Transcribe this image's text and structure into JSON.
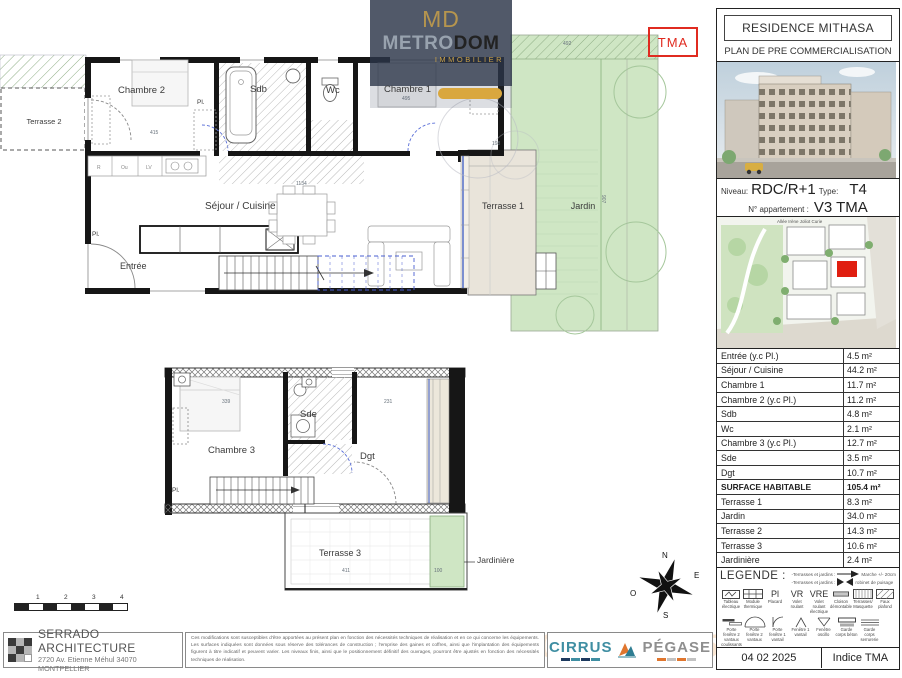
{
  "panel": {
    "title": "RESIDENCE MITHASA",
    "subtitle": "PLAN DE PRE COMMERCIALISATION",
    "niveau_label": "Niveau:",
    "niveau_value": "RDC/R+1",
    "type_label": "Type:",
    "type_value": "T4",
    "apartment_label": "N° appartement :",
    "apartment_value": "V3 TMA",
    "map_street": "Allée Irène Joliot Curie",
    "date": "04 02 2025",
    "indice": "Indice TMA"
  },
  "areas_table": {
    "rows": [
      {
        "label": "Entrée (y.c Pl.)",
        "value": "4.5 m²"
      },
      {
        "label": "Séjour / Cuisine",
        "value": "44.2 m²"
      },
      {
        "label": "Chambre 1",
        "value": "11.7 m²"
      },
      {
        "label": "Chambre 2 (y.c Pl.)",
        "value": "11.2 m²"
      },
      {
        "label": "Sdb",
        "value": "4.8 m²"
      },
      {
        "label": "Wc",
        "value": "2.1 m²"
      },
      {
        "label": "Chambre 3 (y.c Pl.)",
        "value": "12.7 m²"
      },
      {
        "label": "Sde",
        "value": "3.5 m²"
      },
      {
        "label": "Dgt",
        "value": "10.7 m²"
      },
      {
        "label": "SURFACE HABITABLE",
        "value": "105.4 m²"
      },
      {
        "label": "Terrasse 1",
        "value": "8.3 m²"
      },
      {
        "label": "Jardin",
        "value": "34.0 m²"
      },
      {
        "label": "Terrasse 2",
        "value": "14.3 m²"
      },
      {
        "label": "Terrasse 3",
        "value": "10.6 m²"
      },
      {
        "label": "Jardinière",
        "value": "2.4 m²"
      }
    ]
  },
  "legend": {
    "title": "LEGENDE :",
    "note1_label": "-Terrasses et jardins :",
    "note1_desc": "Marche +/- 20cm",
    "note2_label": "-Terrasses et jardins :",
    "note2_desc": "robinet de puisage",
    "codes": {
      "pl": "Pl",
      "vr": "VR",
      "vre": "VRE"
    },
    "row1": [
      "Tableau électrique",
      "Module thermique",
      "Placard",
      "Volet roulant",
      "Volet roulant électrique",
      "Cloison démontable",
      "Terrasses/ Masquette",
      "Faux plafond"
    ],
    "row2": [
      "Porte fenêtre 2 vantaux coulissants",
      "Porte fenêtre 2 vantaux",
      "Porte fenêtre 1 vantail",
      "Fenêtre 1 vantail",
      "Fenêtre oscillo",
      "Garde corps béton",
      "Garde corps serrurerie"
    ]
  },
  "rooms": {
    "terrasse2": "Terrasse 2",
    "chambre2": "Chambre 2",
    "sdb": "Sdb",
    "wc": "Wc",
    "chambre1": "Chambre 1",
    "pl_a": "Pl.",
    "sejour": "Séjour / Cuisine",
    "pl_b": "Pl.",
    "entree": "Entrée",
    "terrasse1": "Terrasse 1",
    "jardin": "Jardin",
    "chambre3": "Chambre 3",
    "sde": "Sde",
    "dgt": "Dgt",
    "pl_c": "Pl.",
    "terrasse3": "Terrasse 3",
    "jardiniere": "Jardinière"
  },
  "dims": {
    "d415": "415",
    "d495": "495",
    "d1134": "1134",
    "d198": "198",
    "d492": "492",
    "d907": "907",
    "d339": "339",
    "d231": "231",
    "d411": "411",
    "d100": "100"
  },
  "kitchen": [
    "R",
    "Ou",
    "LV"
  ],
  "annotations": {
    "tma": "TMA"
  },
  "compass": {
    "n": "N",
    "s": "S",
    "e": "E",
    "o": "O"
  },
  "scalebar": [
    "1",
    "2",
    "3",
    "4"
  ],
  "watermark": {
    "monogram": "MD",
    "brand_a": "METRO",
    "brand_b": "DOM",
    "tagline": "IMMOBILIER"
  },
  "footer": {
    "architect_name": "SERRADO ARCHITECTURE",
    "architect_address": "2720 Av. Etienne Méhul 34070 MONTPELLIER",
    "disclaimer": "Ces modifications sont susceptibles d'être apportées au présent plan en fonction des nécessités techniques de réalisation et en ce qui concerne les équipements. Les surfaces indiquées sont données sous réserve des tolérances de construction ; l'emprise des gaines et coffres, ainsi que l'implantation des équipements figurent à titre indicatif et peuvent varier. Les niveaux finis, ainsi que le positionnement définitif des ouvrages, pourront être ajustés en fonction des nécessités techniques de réalisation.",
    "logo1": "CIRRUS",
    "logo2": "PÉGASE",
    "date_watermark": "04 02 2025"
  },
  "colors": {
    "garden_green": "#cfe6c4",
    "terrace_beige": "#e9e4da",
    "accent_red": "#e02b20",
    "gold": "#c8a04a",
    "cirrus_teal": "#3f8ea2",
    "pegase_orange": "#e0762e"
  }
}
